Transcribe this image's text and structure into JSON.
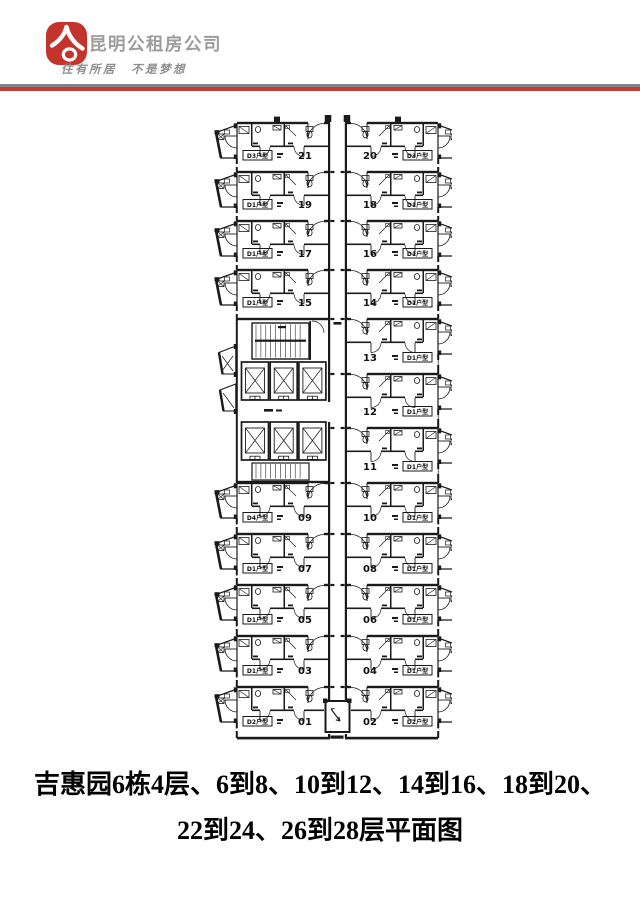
{
  "header": {
    "company_name": "昆明公租房公司",
    "slogan": "住有所居　不是梦想",
    "logo_color": "#c2342c",
    "divider_gray": "#83838b",
    "divider_red": "#c63b33"
  },
  "title": {
    "line1": "吉惠园6栋4层、6到8、10到12、14到16、18到20、",
    "line2": "22到24、26到28层平面图"
  },
  "floor_plan": {
    "line_color": "#1a1a1a",
    "units_left": [
      {
        "no": "21",
        "type": "D3户型"
      },
      {
        "no": "19",
        "type": "D1户型"
      },
      {
        "no": "17",
        "type": "D1户型"
      },
      {
        "no": "15",
        "type": "D1户型"
      },
      {
        "no": "09",
        "type": "D4户型"
      },
      {
        "no": "07",
        "type": "D1户型"
      },
      {
        "no": "05",
        "type": "D1户型"
      },
      {
        "no": "03",
        "type": "D1户型"
      },
      {
        "no": "01",
        "type": "D2户型"
      }
    ],
    "units_right": [
      {
        "no": "20",
        "type": "D3户型"
      },
      {
        "no": "18",
        "type": "D1户型"
      },
      {
        "no": "16",
        "type": "D1户型"
      },
      {
        "no": "14",
        "type": "D1户型"
      },
      {
        "no": "13",
        "type": "D1户型"
      },
      {
        "no": "12",
        "type": "D1户型"
      },
      {
        "no": "11",
        "type": "D1户型"
      },
      {
        "no": "10",
        "type": "D1户型"
      },
      {
        "no": "08",
        "type": "D1户型"
      },
      {
        "no": "06",
        "type": "D1户型"
      },
      {
        "no": "04",
        "type": "D1户型"
      },
      {
        "no": "02",
        "type": "D2户型"
      }
    ],
    "core": {
      "stairs": 2,
      "elevators": 6
    }
  }
}
